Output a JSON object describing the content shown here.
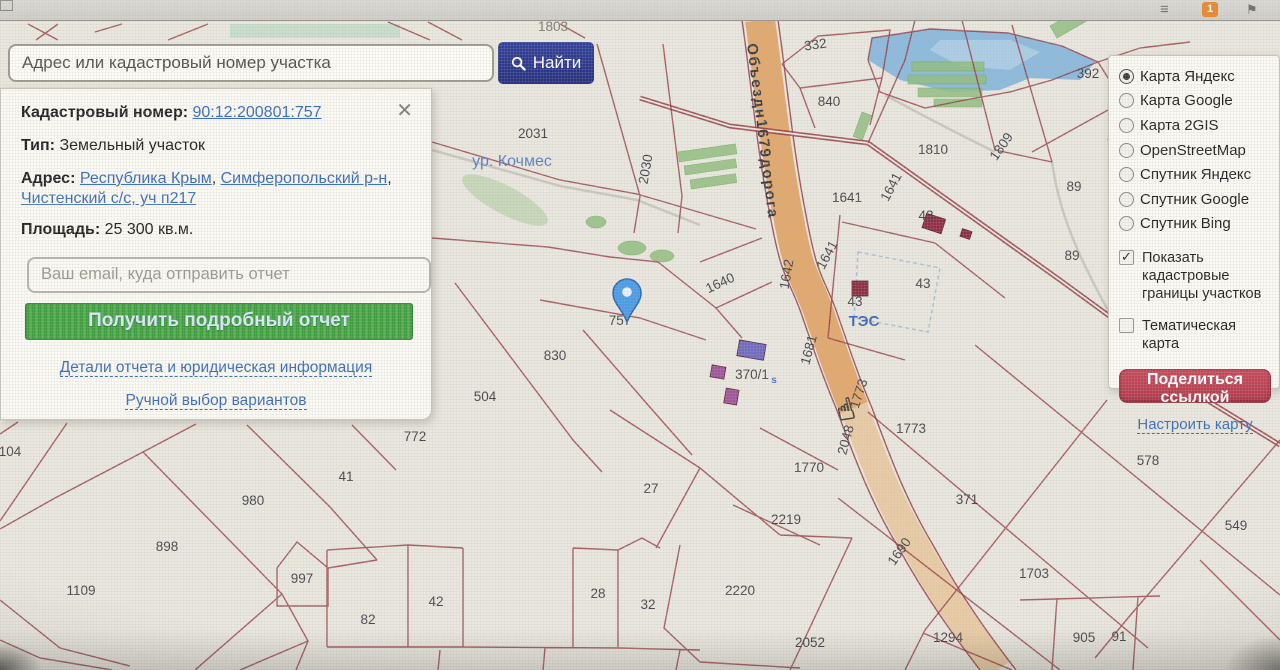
{
  "browser_bar": {
    "downloads_badge": "1"
  },
  "search": {
    "placeholder": "Адрес или кадастровый номер участка",
    "button": "Найти"
  },
  "parcel_panel": {
    "cadastral_label": "Кадастровый номер:",
    "cadastral_number": "90:12:200801:757",
    "type_label": "Тип:",
    "type_value": "Земельный участок",
    "address_label": "Адрес:",
    "address_links": [
      "Республика Крым",
      "Симферопольский р-н",
      "Чистенский с/с, уч п217"
    ],
    "area_label": "Площадь:",
    "area_value": "25 300 кв.м.",
    "email_placeholder": "Ваш email, куда отправить отчет",
    "report_button": "Получить подробный отчет",
    "details_link": "Детали отчета и юридическая информация",
    "manual_link": "Ручной выбор вариантов",
    "close": "✕"
  },
  "layers_panel": {
    "base_layers": [
      {
        "label": "Карта Яндекс",
        "selected": true
      },
      {
        "label": "Карта Google",
        "selected": false
      },
      {
        "label": "Карта 2GIS",
        "selected": false
      },
      {
        "label": "OpenStreetMap",
        "selected": false
      },
      {
        "label": "Спутник Яндекс",
        "selected": false
      },
      {
        "label": "Спутник Google",
        "selected": false
      },
      {
        "label": "Спутник Bing",
        "selected": false
      }
    ],
    "checkboxes": [
      {
        "label": "Показать кадастровые границы участков",
        "checked": true
      },
      {
        "label": "Тематическая карта",
        "checked": false
      }
    ],
    "share_button": "Поделиться ссылкой",
    "configure_link": "Настроить карту"
  },
  "map": {
    "place_label": "ур. Кочмес",
    "road_label": "Объездн1679дорога",
    "station_label": "ТЭС",
    "marker_parcel": "757",
    "colors": {
      "parcel_line": "#8e3039",
      "road_fill": "#e2a160",
      "road_fill_light": "#e9c99e",
      "water": "#8cbade",
      "green": "#90bd7e",
      "marker": "#4a9be8"
    },
    "parcel_labels": [
      {
        "t": "1803",
        "x": 553,
        "y": 31,
        "c": "faint"
      },
      {
        "t": "2031",
        "x": 533,
        "y": 138
      },
      {
        "t": "2030",
        "x": 650,
        "y": 170,
        "r": -80
      },
      {
        "t": "332",
        "x": 816,
        "y": 49,
        "r": -8
      },
      {
        "t": "840",
        "x": 829,
        "y": 106
      },
      {
        "t": "392",
        "x": 1088,
        "y": 78
      },
      {
        "t": "1810",
        "x": 933,
        "y": 154
      },
      {
        "t": "1809",
        "x": 1005,
        "y": 149,
        "r": -55
      },
      {
        "t": "89",
        "x": 1074,
        "y": 191
      },
      {
        "t": "89",
        "x": 1072,
        "y": 260
      },
      {
        "t": "1641",
        "x": 847,
        "y": 202
      },
      {
        "t": "1641",
        "x": 895,
        "y": 189,
        "r": -62
      },
      {
        "t": "1641",
        "x": 831,
        "y": 257,
        "r": -62
      },
      {
        "t": "43",
        "x": 926,
        "y": 220
      },
      {
        "t": "43",
        "x": 923,
        "y": 288
      },
      {
        "t": "43",
        "x": 855,
        "y": 306
      },
      {
        "t": "1640",
        "x": 722,
        "y": 287,
        "r": -25
      },
      {
        "t": "1642",
        "x": 791,
        "y": 275,
        "r": -80
      },
      {
        "t": "1681",
        "x": 813,
        "y": 351,
        "r": -75
      },
      {
        "t": "757",
        "x": 620,
        "y": 325
      },
      {
        "t": "830",
        "x": 555,
        "y": 360
      },
      {
        "t": "504",
        "x": 485,
        "y": 401
      },
      {
        "t": "370/1",
        "x": 752,
        "y": 379
      },
      {
        "t": "s",
        "x": 774,
        "y": 383,
        "c": "sub"
      },
      {
        "t": "772",
        "x": 415,
        "y": 441
      },
      {
        "t": "104",
        "x": 10,
        "y": 456
      },
      {
        "t": "76",
        "x": 5,
        "y": 295
      },
      {
        "t": "41",
        "x": 346,
        "y": 481
      },
      {
        "t": "980",
        "x": 253,
        "y": 505
      },
      {
        "t": "898",
        "x": 167,
        "y": 551
      },
      {
        "t": "1109",
        "x": 81,
        "y": 595
      },
      {
        "t": "997",
        "x": 302,
        "y": 583
      },
      {
        "t": "82",
        "x": 368,
        "y": 624
      },
      {
        "t": "42",
        "x": 436,
        "y": 606
      },
      {
        "t": "28",
        "x": 598,
        "y": 598
      },
      {
        "t": "32",
        "x": 648,
        "y": 609
      },
      {
        "t": "27",
        "x": 651,
        "y": 493
      },
      {
        "t": "1770",
        "x": 809,
        "y": 472
      },
      {
        "t": "2219",
        "x": 786,
        "y": 524
      },
      {
        "t": "2220",
        "x": 740,
        "y": 595
      },
      {
        "t": "2052",
        "x": 810,
        "y": 647
      },
      {
        "t": "1773",
        "x": 863,
        "y": 395,
        "r": -72
      },
      {
        "t": "1773",
        "x": 911,
        "y": 433
      },
      {
        "t": "2048",
        "x": 850,
        "y": 441,
        "r": -75
      },
      {
        "t": "1690",
        "x": 903,
        "y": 554,
        "r": -55
      },
      {
        "t": "371",
        "x": 967,
        "y": 504
      },
      {
        "t": "578",
        "x": 1148,
        "y": 465
      },
      {
        "t": "549",
        "x": 1236,
        "y": 530
      },
      {
        "t": "1703",
        "x": 1034,
        "y": 578
      },
      {
        "t": "1294",
        "x": 948,
        "y": 642
      },
      {
        "t": "905",
        "x": 1084,
        "y": 642
      },
      {
        "t": "91",
        "x": 1119,
        "y": 641
      },
      {
        "t": "1811",
        "x": 1225,
        "y": 372
      }
    ]
  }
}
